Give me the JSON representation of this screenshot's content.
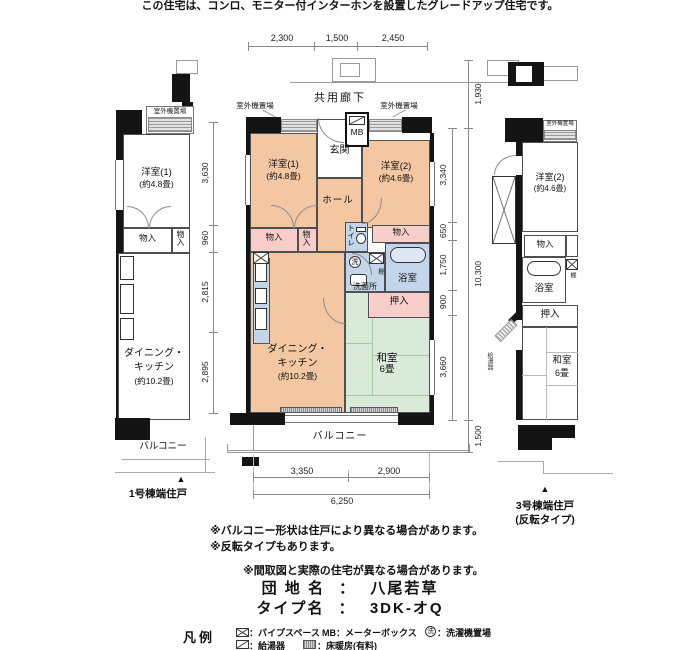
{
  "page": {
    "top_note": "この住宅は、コンロ、モニター付インターホンを設置したグレードアップ住宅です。"
  },
  "shared": {
    "outdoor_unit": "室外機置場",
    "closet": "物入",
    "oshiire": "押入",
    "bathroom": "浴室",
    "balcony": "バルコニー",
    "washitsu": "和室",
    "washitsu_size": "6畳",
    "marker": "▲"
  },
  "center": {
    "corridor": "共用廊下",
    "mb": "MB",
    "genkan": "玄関",
    "hall": "ホール",
    "room1": "洋室(1)",
    "room1_size": "(約4.8畳)",
    "room2": "洋室(2)",
    "room2_size": "(約4.6畳)",
    "toilet": "トイレ",
    "washroom": "洗面所",
    "laundry": "洗",
    "shelf": "棚",
    "dk_line1": "ダイニング・",
    "dk_line2": "キッチン",
    "dk_size": "(約10.2畳)",
    "dims_top": [
      "2,300",
      "1,500",
      "2,450"
    ],
    "dims_left": [
      "3,630",
      "960",
      "2,815",
      "2,895"
    ],
    "dims_right": [
      "3,340",
      "650",
      "1,750",
      "900",
      "3,660"
    ],
    "dim_corridor": "1,930",
    "dim_total_v": "10,300",
    "dim_balcony": "1,500",
    "dims_bottom": [
      "3,350",
      "2,900"
    ],
    "dim_total_h": "6,250"
  },
  "left_unit": {
    "room1": "洋室(1)",
    "room1_size": "(約4.8畳)",
    "dk_line1": "ダイニング・",
    "dk_line2": "キッチン",
    "dk_size": "(約10.2畳)",
    "caption": "1号棟端住戸"
  },
  "right_unit": {
    "outdoor_unit": "室外機置場",
    "room2": "洋室(2)",
    "room2_size": "(約4.6畳)",
    "water_heater": "給湯器",
    "caption1": "3号棟端住戸",
    "caption2": "(反転タイプ)"
  },
  "notes": [
    "※バルコニー形状は住戸により異なる場合があります。",
    "※反転タイプもあります。",
    "※間取図と実際の住宅が異なる場合があります。"
  ],
  "info": {
    "estate_label": "団 地 名",
    "estate_sep": "：",
    "estate_value": "八尾若草",
    "type_label": "タイプ名",
    "type_sep": "：",
    "type_value": "3DK-オQ"
  },
  "legend": {
    "title": "凡例",
    "pipe_label": "：パイプスペース",
    "mb_label": "MB：メーターボックス",
    "laundry_symbol": "洗",
    "laundry_label": "：洗濯機置場",
    "heater_label": "：給湯器",
    "heating_label": "：床暖房(有料)"
  },
  "colors": {
    "room_peach": "#f2c7a1",
    "closet_pink": "#f7cec9",
    "water_blue": "#c3d5ea",
    "tatami_green": "#d9ead9"
  }
}
